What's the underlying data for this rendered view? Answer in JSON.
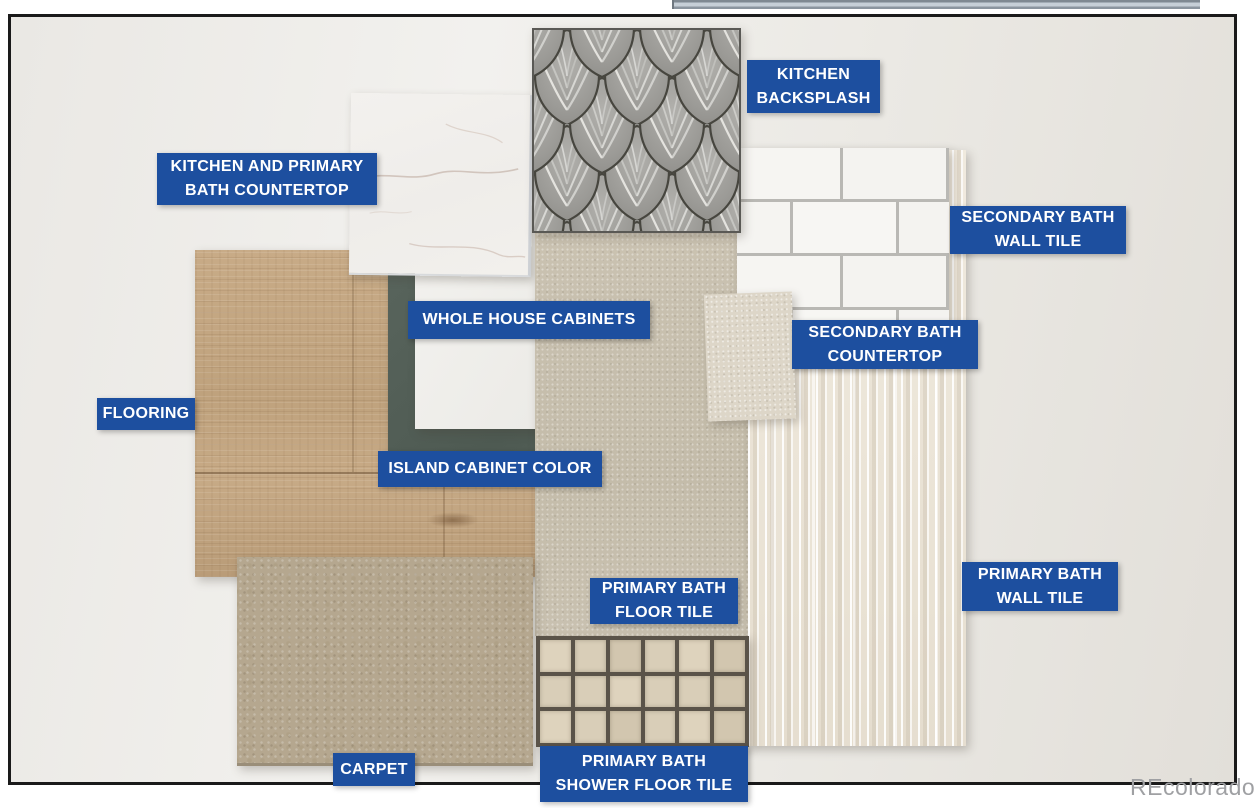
{
  "theme": {
    "label_bg": "#1d4f9f",
    "label_text": "#ffffff",
    "frame": "#1a1a1a",
    "watermark": "#9fa0a3"
  },
  "watermark": {
    "text": "REcolorado"
  },
  "labels": [
    {
      "key": "kitchen-backsplash",
      "text": "KITCHEN\nBACKSPLASH"
    },
    {
      "key": "kitchen-and-primary-bath-countertop",
      "text": "KITCHEN AND PRIMARY\nBATH COUNTERTOP"
    },
    {
      "key": "secondary-bath-wall-tile",
      "text": "SECONDARY BATH\nWALL TILE"
    },
    {
      "key": "whole-house-cabinets",
      "text": "WHOLE HOUSE CABINETS"
    },
    {
      "key": "secondary-bath-countertop",
      "text": "SECONDARY BATH\nCOUNTERTOP"
    },
    {
      "key": "flooring",
      "text": "FLOORING"
    },
    {
      "key": "island-cabinet-color",
      "text": "ISLAND CABINET COLOR"
    },
    {
      "key": "primary-bath-floor-tile",
      "text": "PRIMARY BATH\nFLOOR TILE"
    },
    {
      "key": "primary-bath-wall-tile",
      "text": "PRIMARY BATH\nWALL TILE"
    },
    {
      "key": "carpet",
      "text": "CARPET"
    },
    {
      "key": "primary-bath-shower-floor-tile",
      "text": "PRIMARY BATH\nSHOWER FLOOR TILE"
    }
  ],
  "materials": {
    "flooring": {
      "name": "wood-look plank flooring",
      "base": "#c3a583"
    },
    "island": {
      "name": "island cabinet color sample",
      "base": "#58645c"
    },
    "cabinets": {
      "name": "whole house cabinet panel",
      "base": "#f2f1ed"
    },
    "countertop": {
      "name": "white quartz with grey veining",
      "base": "#f1efec"
    },
    "backsplash": {
      "name": "grey scalloped fan-scale tile",
      "base": "#90908c"
    },
    "subway": {
      "name": "white subway wall tile",
      "tile": "#f6f5f2",
      "grout": "#b9b8b4"
    },
    "secondary_countertop": {
      "name": "beige solid surface chip",
      "base": "#ddd6c8"
    },
    "primary_floor_tile": {
      "name": "greige large-format tile",
      "base": "#c8c0ae"
    },
    "fluted": {
      "name": "cream fluted wall tile",
      "base": "#ece5d8"
    },
    "carpet": {
      "name": "taupe patterned carpet",
      "base": "#b5a78f"
    },
    "mosaic": {
      "name": "beige square mosaic",
      "rows": 3,
      "cols": 6,
      "grout": "#5a5349",
      "tile": "#d9ceb8"
    }
  }
}
